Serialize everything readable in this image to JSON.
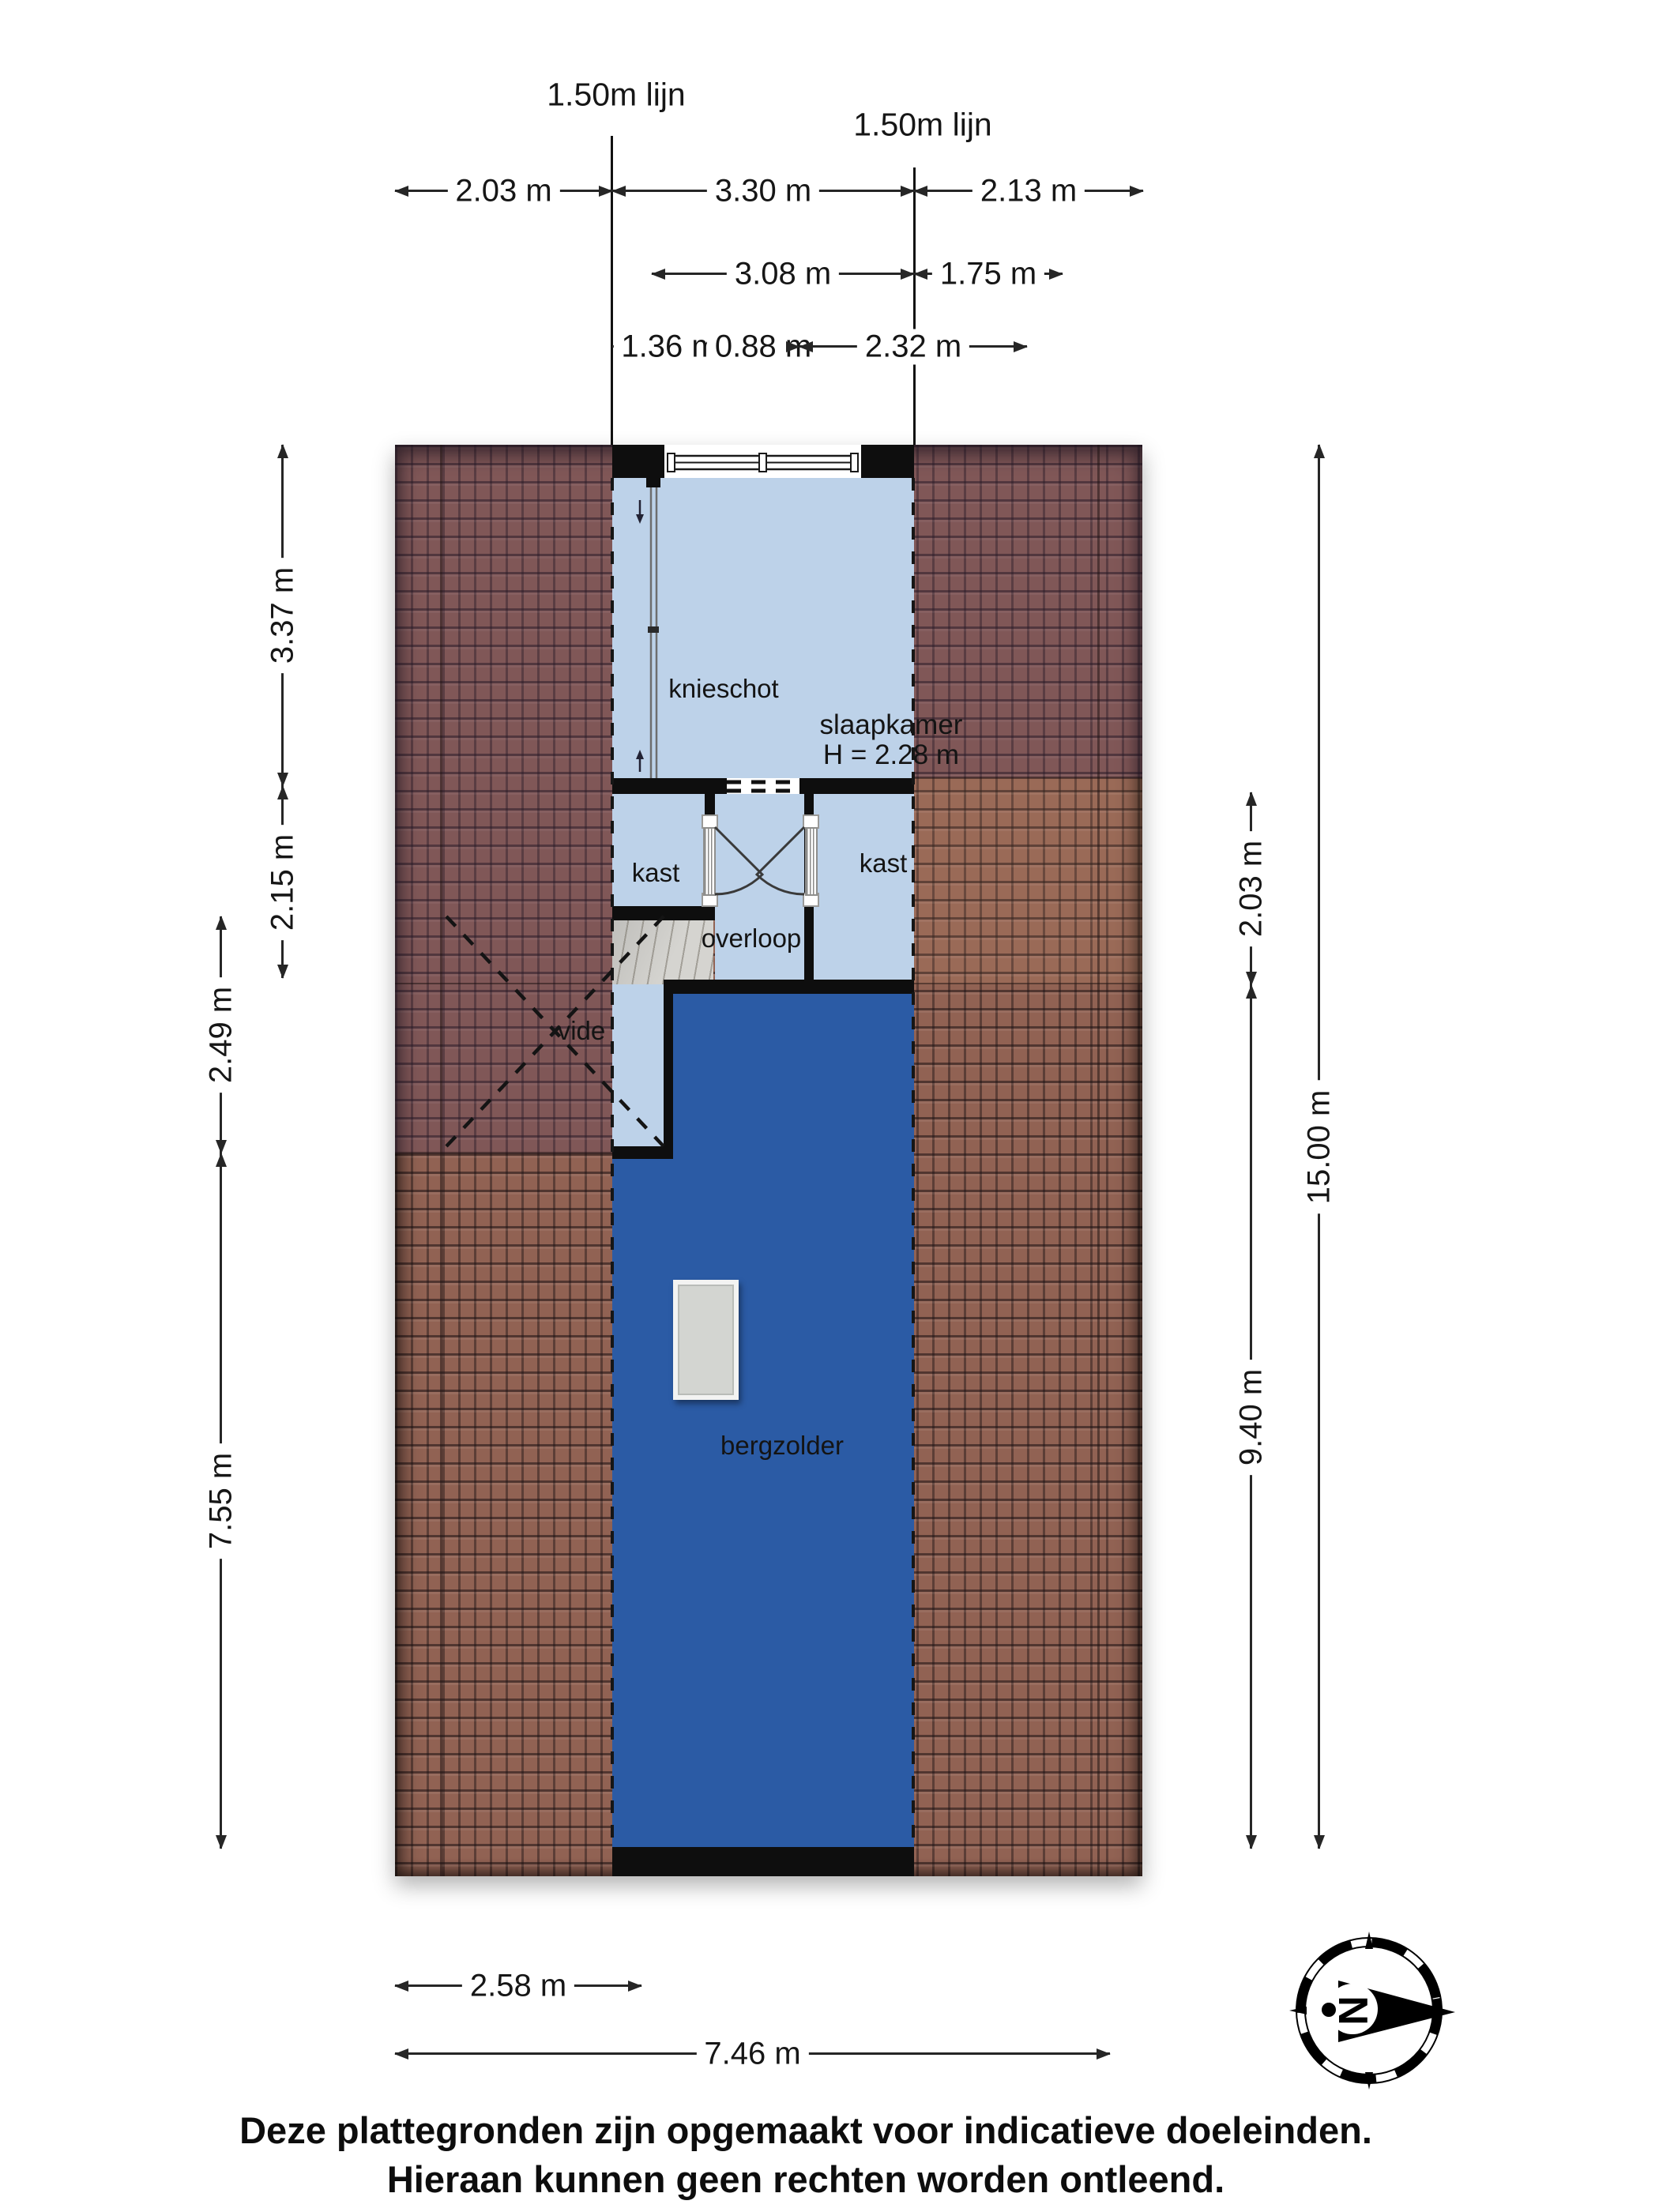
{
  "colors": {
    "roomLight": "#bdd2e9",
    "roomDark": "#2b5ba5",
    "roof": "#916253",
    "wall": "#0e0e0e",
    "stairs": "#d5d4d0",
    "skylight": "#d3d5d1"
  },
  "topLines": {
    "left": "1.50m lijn",
    "right": "1.50m lijn"
  },
  "dims": {
    "row1": [
      "2.03 m",
      "3.30 m",
      "2.13 m"
    ],
    "row2": [
      "3.08 m",
      "1.75 m"
    ],
    "row3": [
      "1.36 m",
      "0.88 m",
      "2.32 m"
    ],
    "left": [
      "3.37 m",
      "2.15 m",
      "2.49 m",
      "7.55 m"
    ],
    "right": [
      "2.03 m",
      "9.40 m",
      "15.00 m"
    ],
    "bottom": [
      "2.58 m",
      "7.46 m"
    ]
  },
  "rooms": {
    "knieschot": "knieschot",
    "slaapkamer": "slaapkamer",
    "slaapkamerHeight": "H = 2.28 m",
    "kastLeft": "kast",
    "kastRight": "kast",
    "overloop": "overloop",
    "vide": "vide",
    "bergzolder": "bergzolder"
  },
  "compass": {
    "north": "N"
  },
  "footer": {
    "line1": "Deze plattegronden zijn opgemaakt voor indicatieve doeleinden.",
    "line2": "Hieraan kunnen geen rechten worden ontleend."
  }
}
